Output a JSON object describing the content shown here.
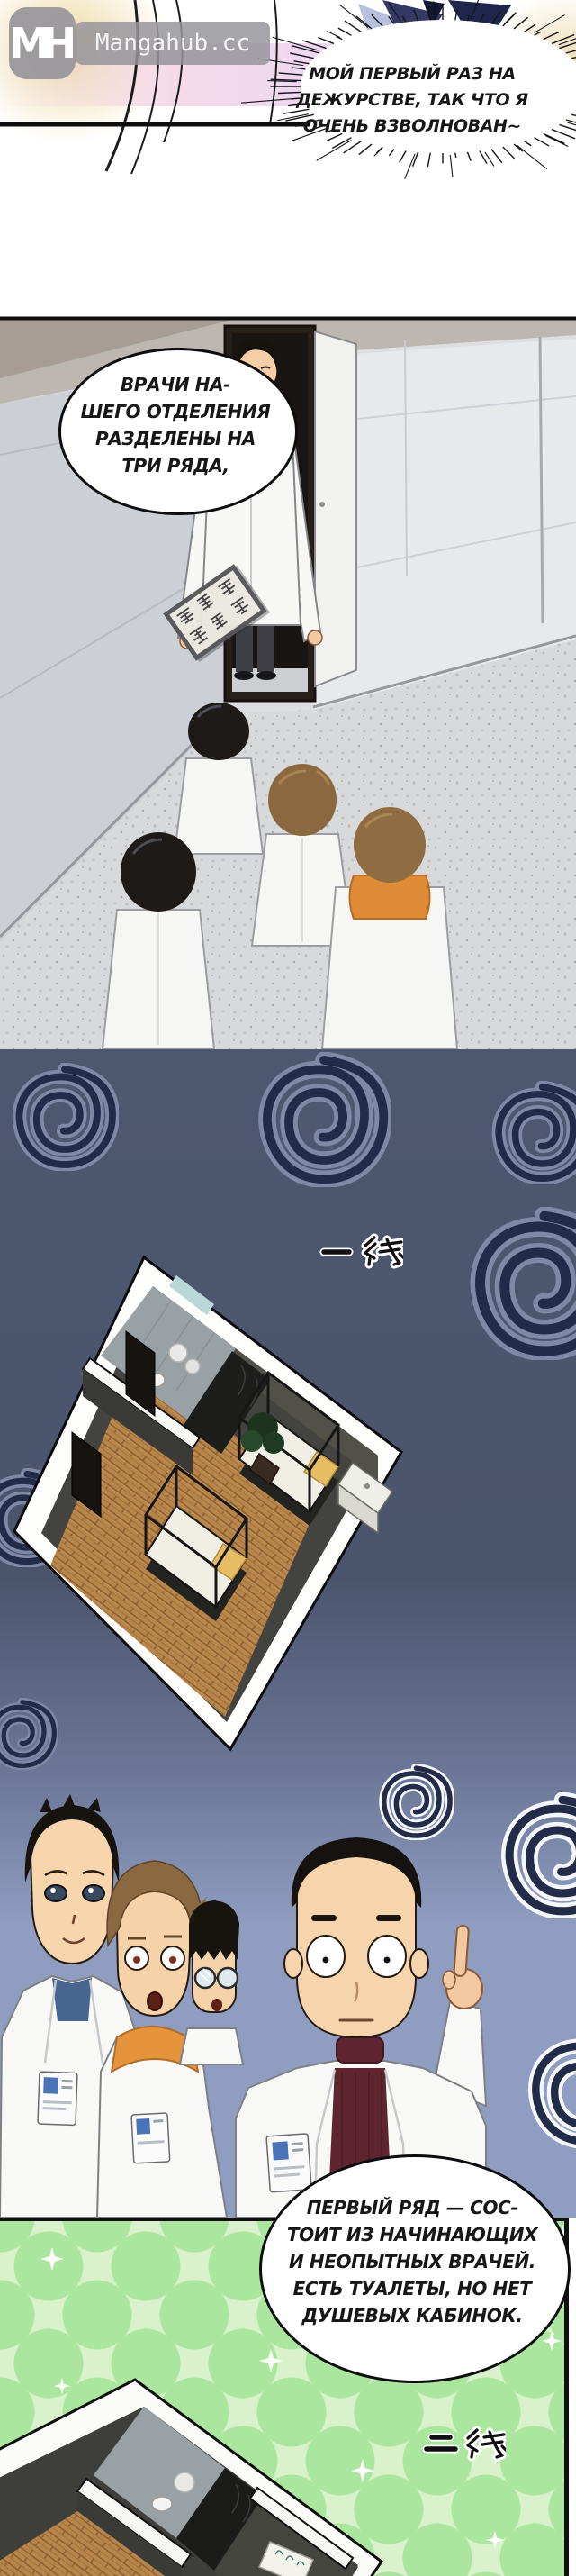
{
  "watermark": {
    "logo": "MH",
    "site_name": "Mangahub.cc"
  },
  "speech_bubbles": {
    "excited": {
      "lines": [
        "МОЙ ПЕРВЫЙ РАЗ НА",
        "ДЕЖУРСТВЕ, ТАК ЧТО Я",
        "ОЧЕНЬ ВЗВОЛНОВАН~"
      ]
    },
    "rows_intro": {
      "lines": [
        "ВРАЧИ НА-",
        "ШЕГО ОТДЕЛЕНИЯ",
        "РАЗДЕЛЕНЫ НА",
        "ТРИ РЯДА,"
      ]
    },
    "first_row": {
      "lines": [
        "ПЕРВЫЙ РЯД — СОС-",
        "ТОИТ ИЗ НАЧИНАЮЩИХ",
        "И НЕОПЫТНЫХ ВРАЧЕЙ.",
        "ЕСТЬ ТУАЛЕТЫ, НО НЕТ",
        "ДУШЕВЫХ КАБИНОК."
      ]
    }
  },
  "captions": {
    "first_line_label": "一 线",
    "second_line_label": "二 线",
    "door_sign_row1": "急诊科",
    "door_sign_row2": "休息室"
  },
  "colors": {
    "dark_panel": "#4e5770",
    "light_panel": "#8e9dc0",
    "green_panel_base": "#d9f2cc",
    "green_panel_dot": "#abe69e",
    "spiral_ink": "#222b47",
    "wood_floor": "#b8854b",
    "watermark_gray": "#98969b"
  }
}
